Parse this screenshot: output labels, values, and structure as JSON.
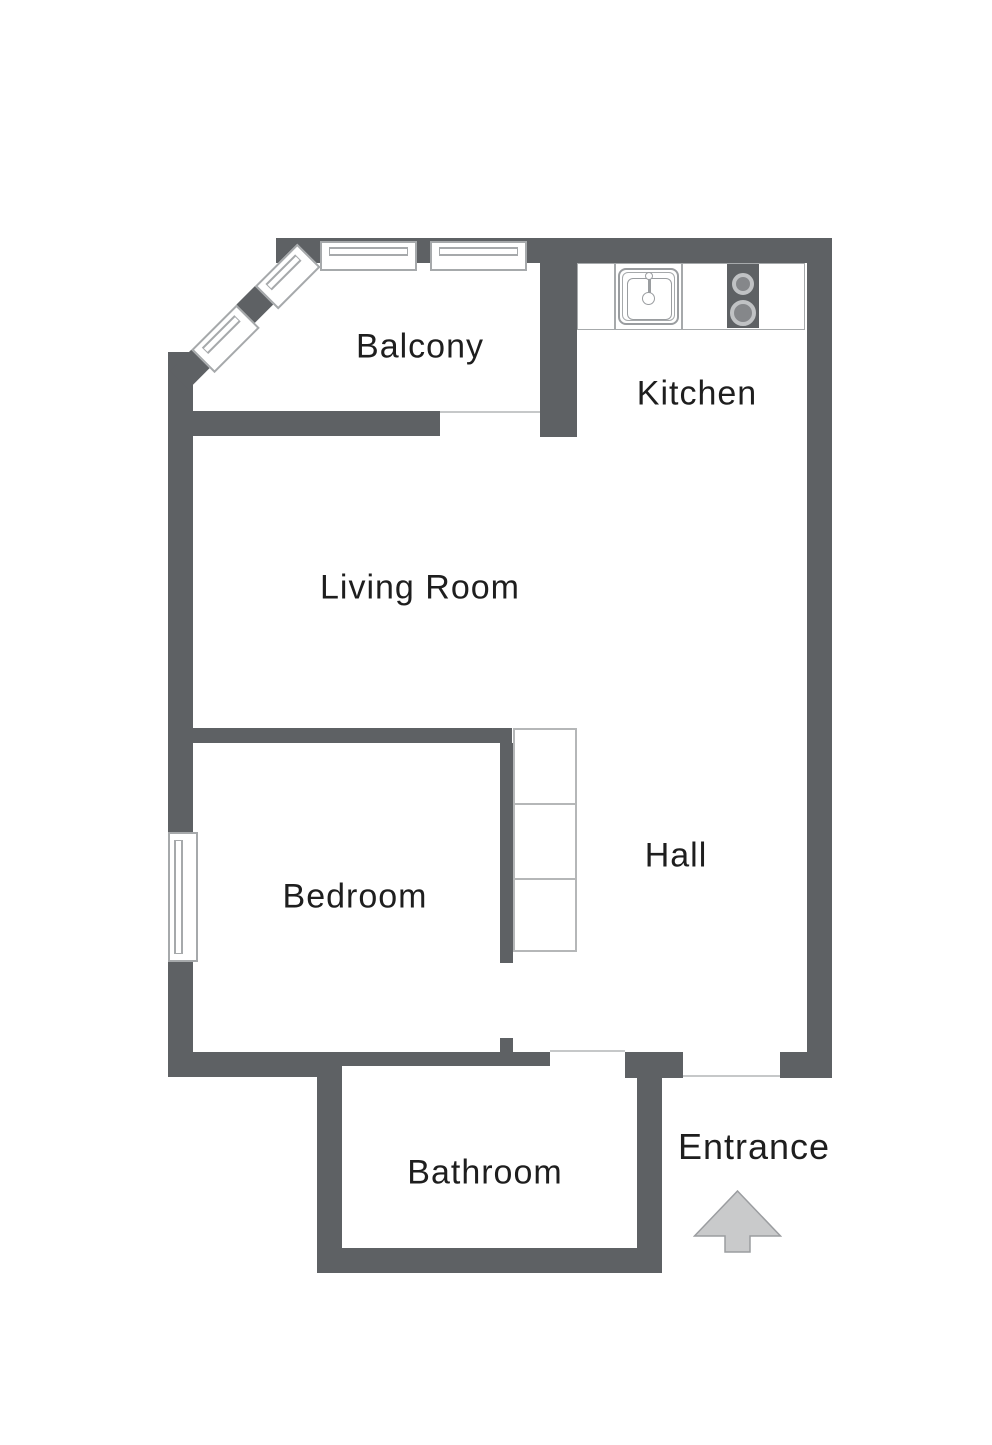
{
  "floorplan": {
    "rooms": {
      "balcony": {
        "label": "Balcony"
      },
      "kitchen": {
        "label": "Kitchen"
      },
      "living_room": {
        "label": "Living Room"
      },
      "bedroom": {
        "label": "Bedroom"
      },
      "hall": {
        "label": "Hall"
      },
      "bathroom": {
        "label": "Bathroom"
      }
    },
    "entrance": {
      "label": "Entrance"
    },
    "icons": {
      "sink": "sink-icon",
      "stove": "stove-icon",
      "entrance_arrow": "entrance-arrow-icon",
      "windows": "window-icon",
      "cabinets": "wardrobe-icon"
    }
  },
  "colors": {
    "wall": "#5e6164",
    "line": "#a6a9ab",
    "thin": "#c6c8c9",
    "text": "#1e1e1e",
    "arrow_fill": "#c9cacb",
    "arrow_stroke": "#9b9da0",
    "background": "#ffffff"
  }
}
